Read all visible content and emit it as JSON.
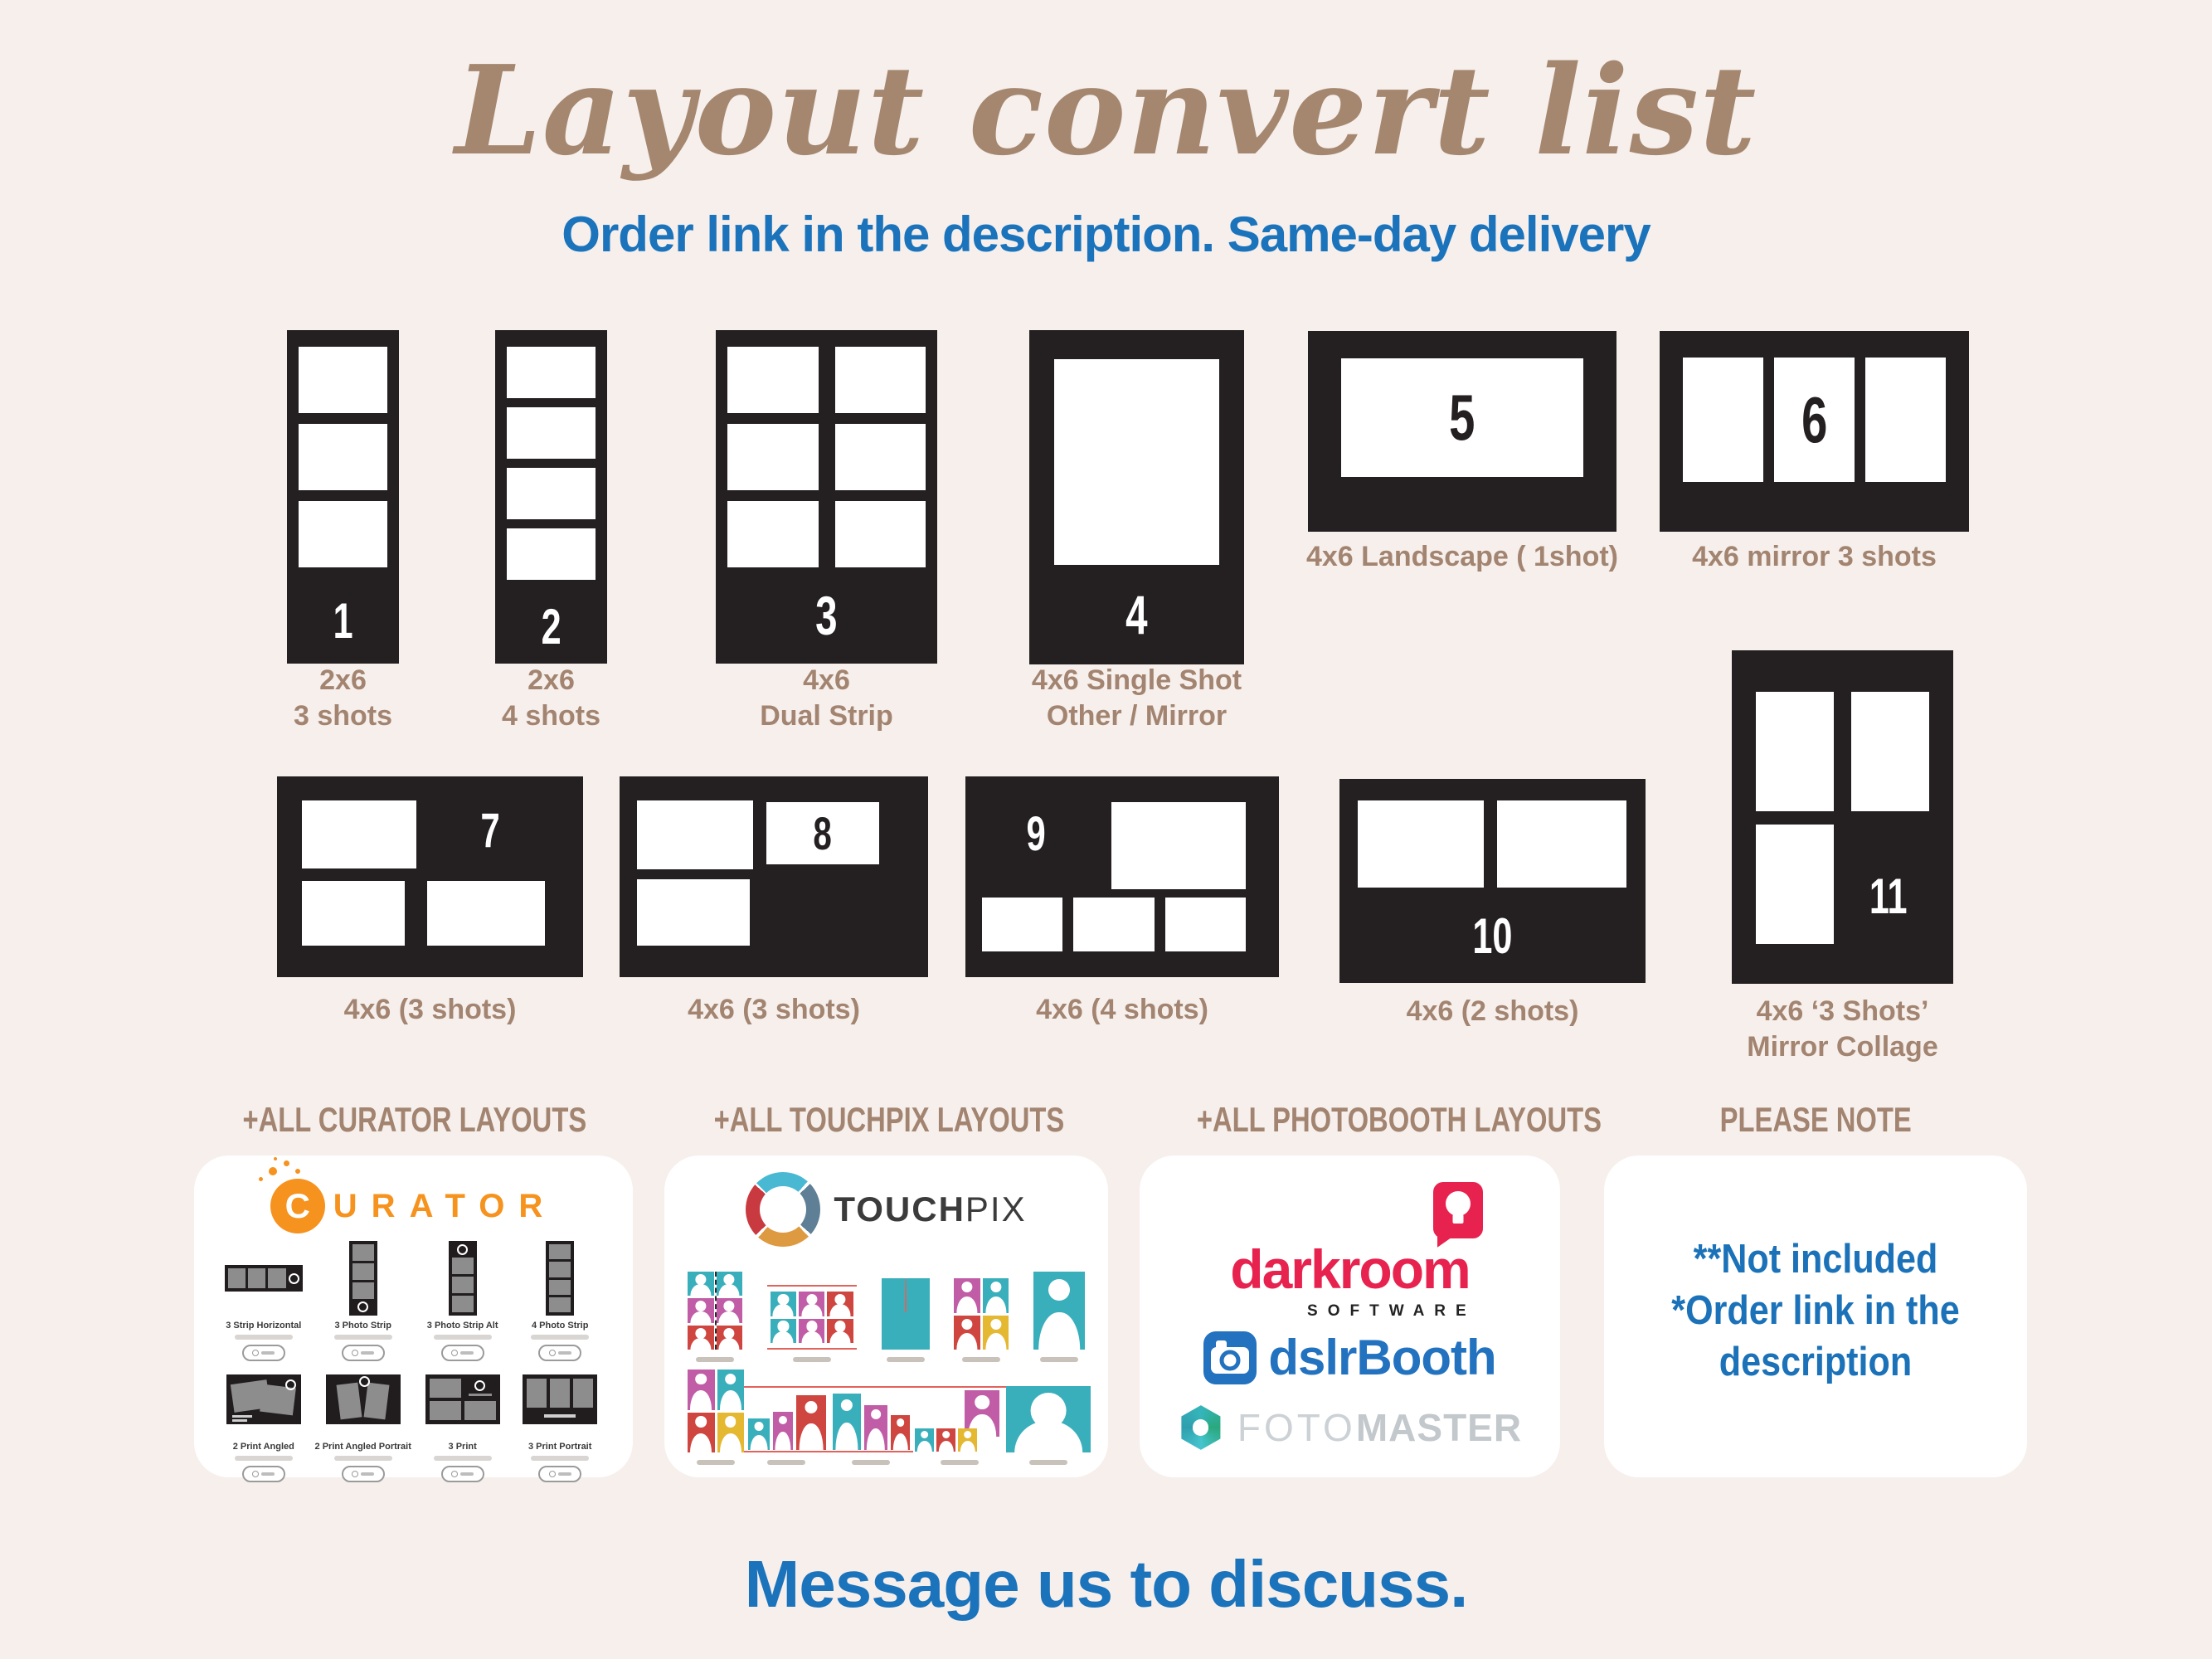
{
  "title": "Layout convert list",
  "subtitle": "Order link in the description. Same-day delivery",
  "footer": "Message us to discuss.",
  "tiles": [
    {
      "num": "1",
      "cap1": "2x6",
      "cap2": "3 shots"
    },
    {
      "num": "2",
      "cap1": "2x6",
      "cap2": "4 shots"
    },
    {
      "num": "3",
      "cap1": "4x6",
      "cap2": "Dual Strip"
    },
    {
      "num": "4",
      "cap1": "4x6 Single Shot",
      "cap2": "Other / Mirror"
    },
    {
      "num": "5",
      "cap1": "4x6 Landscape ( 1shot)",
      "cap2": ""
    },
    {
      "num": "6",
      "cap1": "4x6 mirror 3 shots",
      "cap2": ""
    },
    {
      "num": "7",
      "cap1": "4x6 (3 shots)",
      "cap2": ""
    },
    {
      "num": "8",
      "cap1": "4x6 (3 shots)",
      "cap2": ""
    },
    {
      "num": "9",
      "cap1": "4x6 (4 shots)",
      "cap2": ""
    },
    {
      "num": "10",
      "cap1": "4x6 (2 shots)",
      "cap2": ""
    },
    {
      "num": "11",
      "cap1": "4x6 ‘3 Shots’",
      "cap2": "Mirror Collage"
    }
  ],
  "sections": [
    {
      "label": "+ALL CURATOR LAYOUTS"
    },
    {
      "label": "+ALL TOUCHPIX LAYOUTS"
    },
    {
      "label": "+ALL PHOTOBOOTH LAYOUTS"
    },
    {
      "label": "PLEASE NOTE"
    }
  ],
  "cards": {
    "curator": {
      "brand_initial": "C",
      "brand_rest": "URATOR",
      "items": [
        {
          "label": "3 Strip Horizontal"
        },
        {
          "label": "3 Photo Strip"
        },
        {
          "label": "3 Photo Strip Alt"
        },
        {
          "label": "4 Photo Strip"
        },
        {
          "label": "2 Print Angled"
        },
        {
          "label": "2 Print Angled Portrait"
        },
        {
          "label": "3 Print"
        },
        {
          "label": "3 Print Portrait"
        }
      ]
    },
    "touchpix": {
      "brand_bold": "TOUCH",
      "brand_light": "PIX"
    },
    "photobooth": {
      "darkroom": "darkroom",
      "software": "SOFTWARE",
      "dslr": "dslr",
      "booth": "Booth",
      "foto": "FOTO",
      "master": "MASTER"
    },
    "note": {
      "line1": "**Not included",
      "line2": "*Order link in the",
      "line3": "description"
    }
  },
  "colors": {
    "background": "#f6efec",
    "accent_blue": "#1a73bb",
    "title_brown": "#a5876f",
    "caption_brown": "#a28470",
    "tile_black": "#241f21",
    "curator_orange": "#f6921e",
    "darkroom_red": "#e8224e",
    "dslrbooth_blue": "#2272bf",
    "fotomaster_teal": "#35b5ba",
    "touchpix_teal": "#3aafbc",
    "touchpix_magenta": "#c05da6",
    "touchpix_red": "#cf453f",
    "touchpix_yellow": "#e5b832"
  }
}
